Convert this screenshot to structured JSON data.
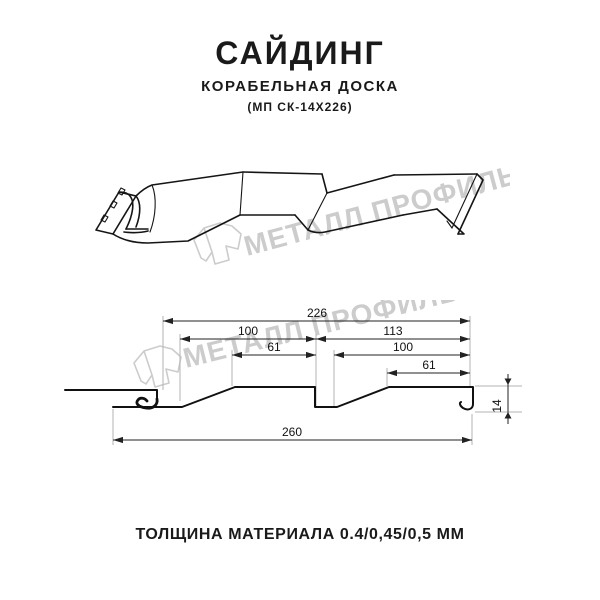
{
  "header": {
    "title": "САЙДИНГ",
    "subtitle": "КОРАБЕЛЬНАЯ ДОСКА",
    "code": "(МП СК-14Х226)"
  },
  "watermark": {
    "text": "МЕТАЛЛ ПРОФИЛЬ"
  },
  "section": {
    "dims": {
      "total_top": "226",
      "left_outer": "100",
      "left_inner": "61",
      "right_outer": "113",
      "right_mid": "100",
      "right_inner": "61",
      "overall_bottom": "260",
      "height": "14"
    }
  },
  "footer": {
    "thickness": "ТОЛЩИНА МАТЕРИАЛА 0.4/0,45/0,5 ММ"
  },
  "colors": {
    "line": "#1a1a1a",
    "dimension": "#222222",
    "extension": "#b3b3b3",
    "watermark": "#cccccc",
    "background": "#ffffff"
  }
}
